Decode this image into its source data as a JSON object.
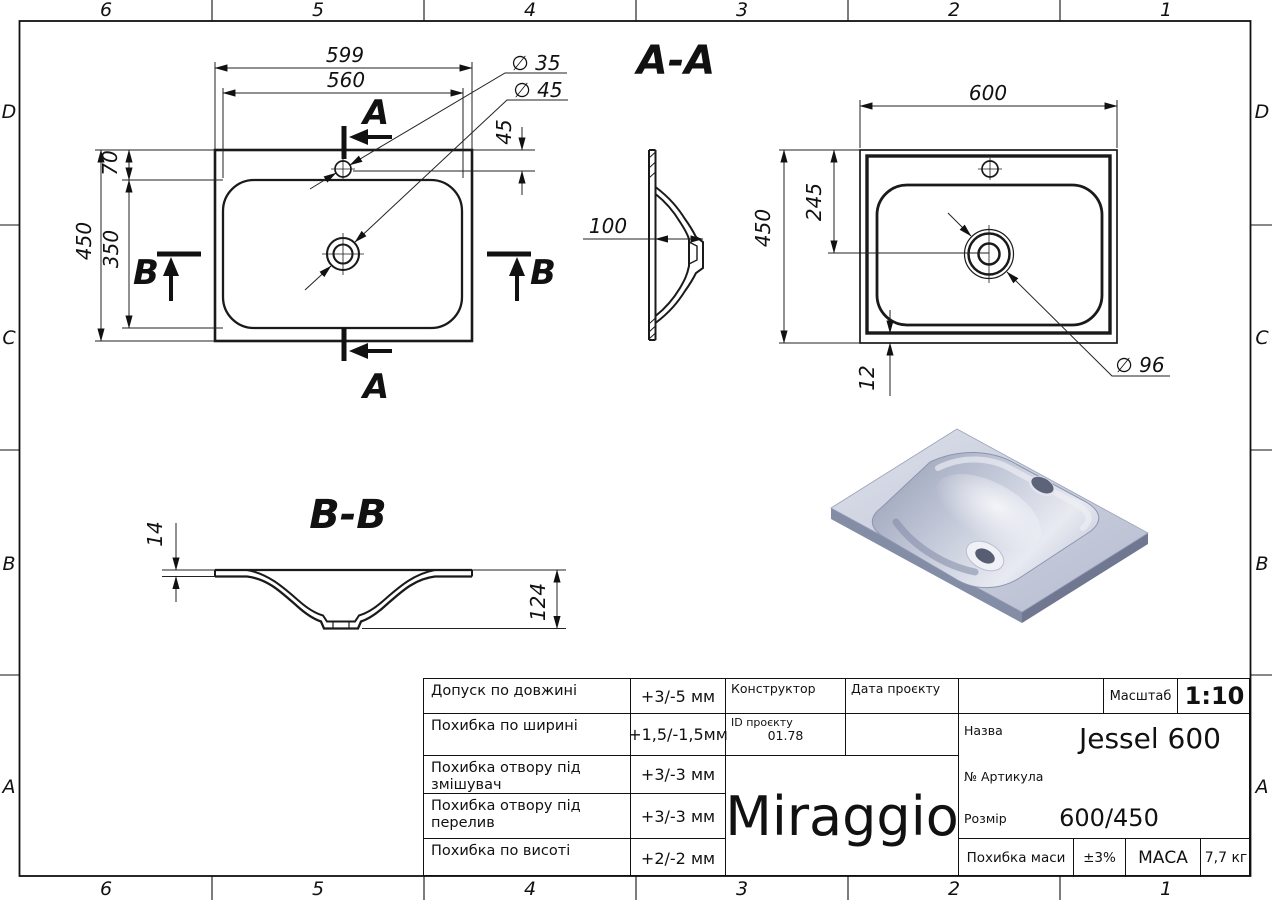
{
  "zones": {
    "cols": [
      "6",
      "5",
      "4",
      "3",
      "2",
      "1"
    ],
    "rows": [
      "D",
      "C",
      "B",
      "A"
    ]
  },
  "plan": {
    "d599": "599",
    "d560": "560",
    "d450": "450",
    "d350": "350",
    "d70": "70",
    "d45": "45",
    "dia35": "∅ 35",
    "dia45": "∅ 45",
    "secA": "A",
    "secB": "B"
  },
  "section_aa": {
    "title": "A-A",
    "d100": "100"
  },
  "bottom_view": {
    "d600": "600",
    "d450": "450",
    "d245": "245",
    "d12": "12",
    "dia96": "∅ 96"
  },
  "section_bb": {
    "title": "B-B",
    "d14": "14",
    "d124": "124"
  },
  "title_block": {
    "tolerances": [
      {
        "label": "Допуск по довжині",
        "value": "+3/-5 мм"
      },
      {
        "label": "Похибка по ширині",
        "value": "+1,5/-1,5мм"
      },
      {
        "label": "Похибка отвору під змішувач",
        "value": "+3/-3 мм"
      },
      {
        "label": "Похибка отвору під перелив",
        "value": "+3/-3 мм"
      },
      {
        "label": "Похибка по висоті",
        "value": "+2/-2 мм"
      }
    ],
    "constructor_label": "Конструктор",
    "date_label": "Дата проєкту",
    "project_id_label": "ID проєкту",
    "project_id_value": "01.78",
    "logo": "Miraggio",
    "scale_label": "Масштаб",
    "scale_value": "1:10",
    "name_label": "Назва",
    "name_value": "Jessel 600",
    "article_label": "№ Артикула",
    "size_label": "Розмір",
    "size_value": "600/450",
    "mass_tol_label": "Похибка маси",
    "mass_tol_value": "±3%",
    "mass_label": "МАСА",
    "mass_value": "7,7 кг"
  },
  "colors": {
    "line": "#1a1a1a",
    "render_top": "#ccd1e0",
    "render_side": "#7e87a1",
    "accent_shadow": "#9aa2bb"
  }
}
